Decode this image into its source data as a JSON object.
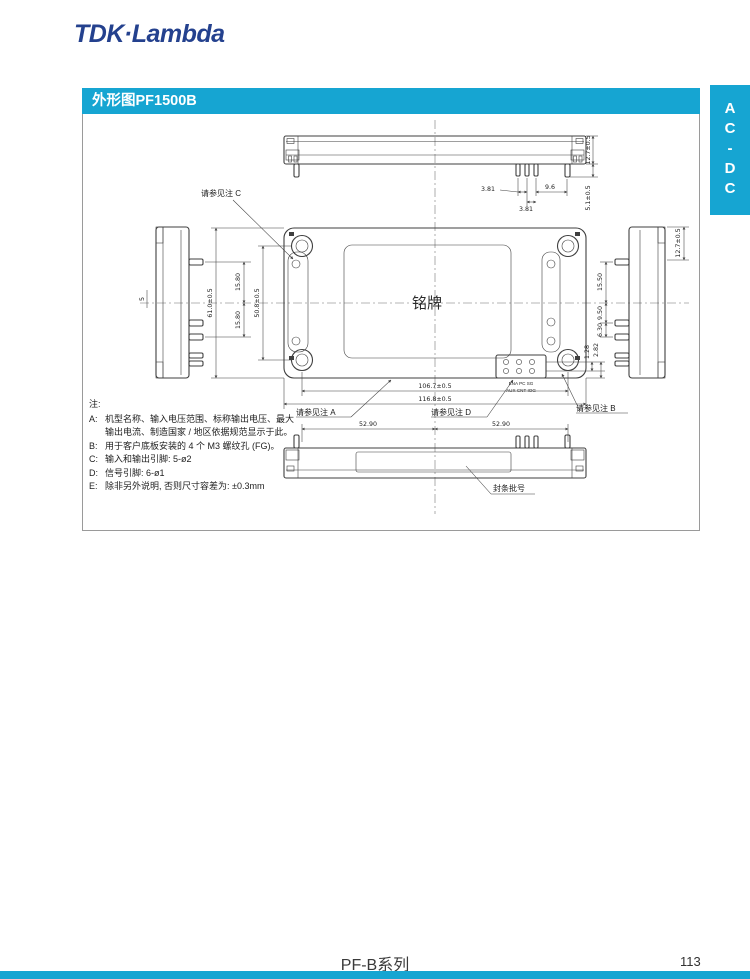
{
  "page": {
    "logo": "TDK·Lambda",
    "section_title": "外形图PF1500B",
    "side_tab": "AC-DC",
    "footer_series": "PF-B系列",
    "footer_page": "113"
  },
  "colors": {
    "accent_teal": "#16a5d2",
    "logo_blue": "#24418e",
    "line": "#3f3f3f"
  },
  "notes": {
    "title": "注:",
    "items": [
      {
        "key": "A:",
        "text": "机型名称、输入电压范围、标称输出电压、最大输出电流、制造国家 / 地区依据规范显示于此。"
      },
      {
        "key": "B:",
        "text": "用于客户底板安装的 4 个 M3 螺纹孔 (FG)。"
      },
      {
        "key": "C:",
        "text": "输入和输出引脚: 5-ø2"
      },
      {
        "key": "D:",
        "text": "信号引脚: 6-ø1"
      },
      {
        "key": "E:",
        "text": "除非另外说明, 否则尺寸容差为: ±0.3mm"
      }
    ]
  },
  "drawing": {
    "labels": {
      "nameplate": "铭牌",
      "seal": "封条批号",
      "note_a": "请参见注 A",
      "note_b": "请参见注 B",
      "note_c": "请参见注 C",
      "note_d": "请参见注 D",
      "conn_row1": "ENA  PC  SG",
      "conn_row2": "AUX CNT  IOG"
    },
    "dims": {
      "pitch_a": "3.81",
      "pitch_b": "3.81",
      "edge_gap": "9.6",
      "height_front": "12.7±0.5",
      "pin_len": "5.1±0.5",
      "left_upper": "15.80",
      "left_lower": "15.80",
      "left_depth": "5",
      "body_h": "61.0±0.5",
      "mount_h": "50.8±0.5",
      "sig_a": "1.28",
      "sig_b": "2.82",
      "mount_w": "106.7±0.5",
      "body_w": "116.8±0.5",
      "right_top": "15.50",
      "right_mid": "9.50",
      "right_low": "6.30",
      "height_side": "12.7±0.5",
      "bottom_left": "52.90",
      "bottom_right": "52.90"
    }
  }
}
